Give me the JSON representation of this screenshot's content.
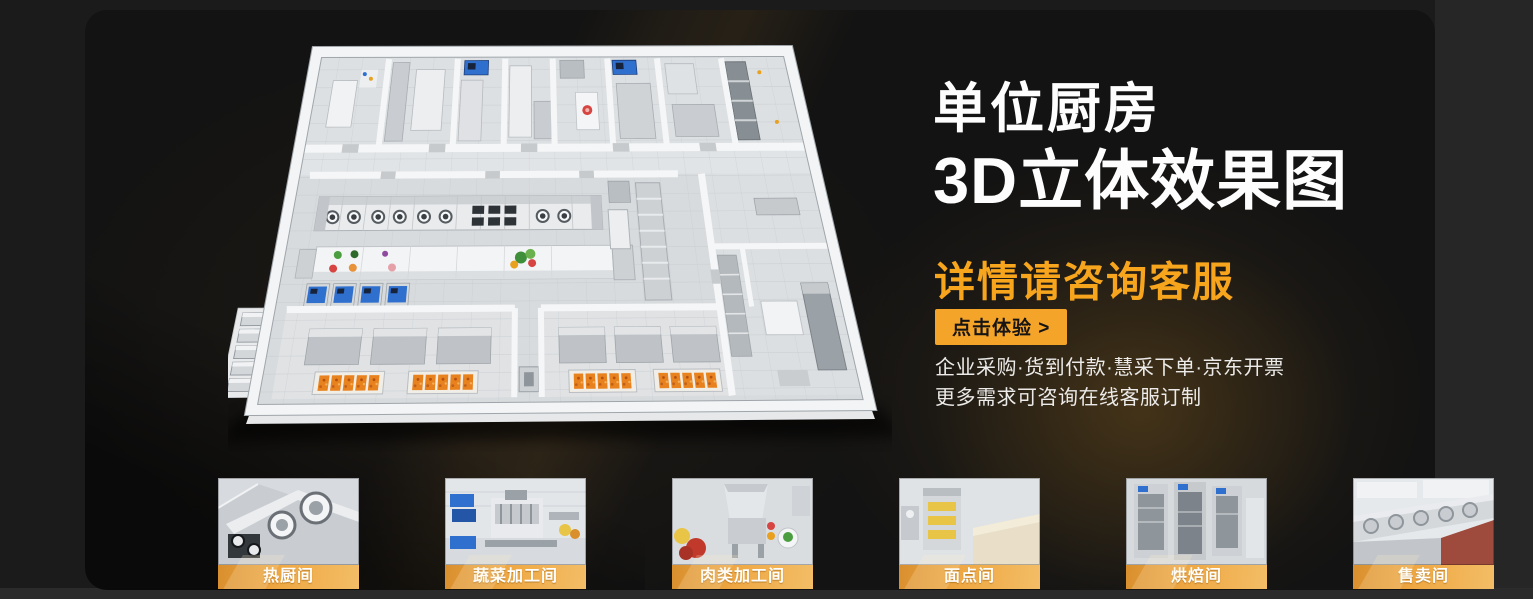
{
  "hero": {
    "title_line1": "单位厨房",
    "title_line2": "3D立体效果图",
    "subtitle": "详情请咨询客服",
    "cta_label": "点击体验 >",
    "features": [
      "企业采购·货到付款·慧采下单·京东开票",
      "更多需求可咨询在线客服订制"
    ]
  },
  "gallery": [
    {
      "label": "热厨间"
    },
    {
      "label": "蔬菜加工间"
    },
    {
      "label": "肉类加工间"
    },
    {
      "label": "面点间"
    },
    {
      "label": "烘焙间"
    },
    {
      "label": "售卖间"
    },
    {
      "label": "凉菜间"
    },
    {
      "label": "消洗间"
    }
  ],
  "colors": {
    "accent_orange": "#F5A42A",
    "subtitle_orange": "#F8A51E",
    "heading_white": "#FDFDFD",
    "panel_background": "#131313",
    "caption_gradient_left": "#D98F2E",
    "caption_gradient_right": "#F3BD66"
  }
}
